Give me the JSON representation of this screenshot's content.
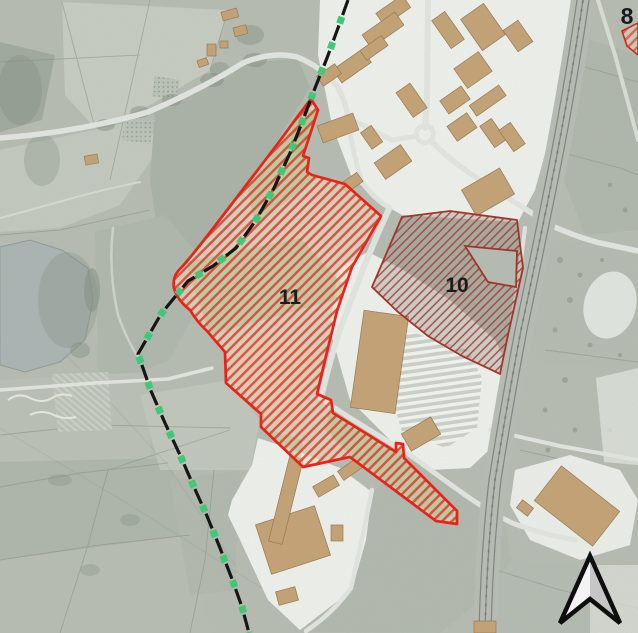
{
  "zones": {
    "z11": {
      "label": "11",
      "border_color": "#e8231a",
      "hatch_color": "#d93a2e",
      "tint_color": "#f0dfc0"
    },
    "z10": {
      "label": "10",
      "border_color": "#9e362e",
      "hatch_color": "#9e4238",
      "tint_color": "#8f7f7a"
    },
    "z8": {
      "label": "8",
      "border_color": "#cc2a20",
      "hatch_color": "#d93a2e"
    }
  },
  "boundary": {
    "line_color": "#161616",
    "marker_color": "#3ec878"
  },
  "north_arrow": {
    "left_fill": "#f4f4f4",
    "right_fill": "#c6c6c6",
    "outline_color": "#0e0e0e"
  },
  "base_map": {
    "field_color": "#b5bbb0",
    "urban_color": "#eff1ec",
    "road_color": "#e3e6e0",
    "building_color": "#c3a072",
    "water_color": "#a9b3b1",
    "rail_color": "#7c837a"
  }
}
